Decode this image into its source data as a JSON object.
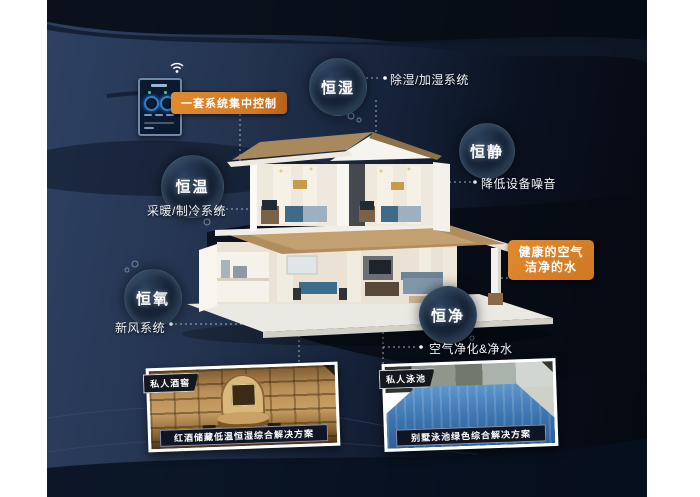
{
  "colors": {
    "accent_orange": "#d9812c",
    "background_navy": "#1c2b47",
    "background_dark": "#05080e",
    "bubble_rim": "#96c3e1",
    "photo_frame": "#ffffff",
    "caption_bar": "#0f1524"
  },
  "control_panel": {
    "chip_label": "一套系统集中控制",
    "wifi_icon": "wifi-signal"
  },
  "bubbles": [
    {
      "label": "恒湿",
      "desc": "除湿/加湿系统"
    },
    {
      "label": "恒静",
      "desc": "降低设备噪音"
    },
    {
      "label": "恒温",
      "desc": "采暖/制冷系统"
    },
    {
      "label": "恒氧",
      "desc": "新风系统"
    },
    {
      "label": "恒净",
      "desc": "空气净化&净水"
    }
  ],
  "callout_box": {
    "line1": "健康的空气",
    "line2": "洁净的水"
  },
  "photos": [
    {
      "tag": "私人酒窖",
      "caption": "红酒储藏低温恒湿综合解决方案"
    },
    {
      "tag": "私人泳池",
      "caption": "别墅泳池绿色综合解决方案"
    }
  ]
}
